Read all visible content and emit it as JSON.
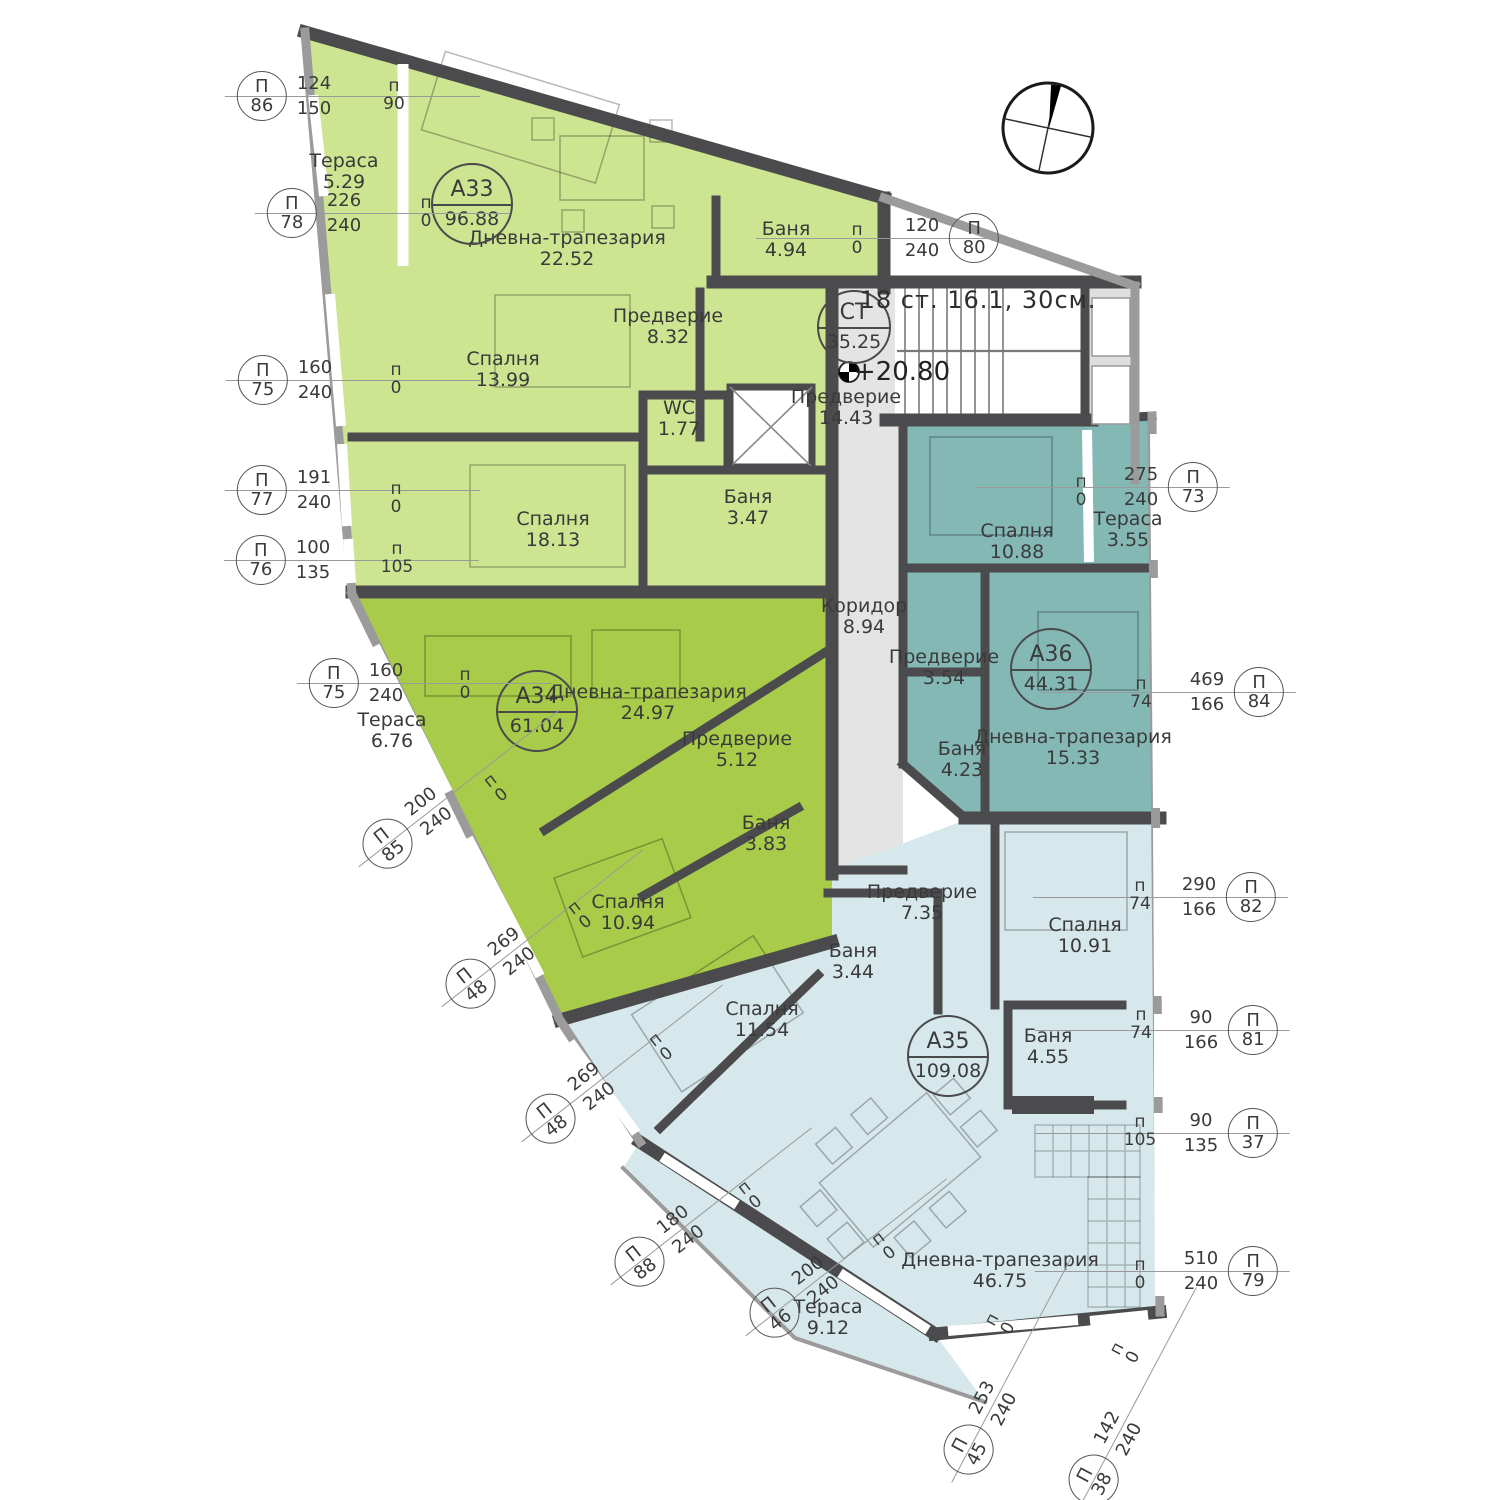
{
  "meta": {
    "tag_letter": "П",
    "sill_letter": "п",
    "plan_type": "apartment-floor-plan"
  },
  "colors": {
    "apartment_a33": "#cde491",
    "apartment_a34": "#a8cc49",
    "apartment_a35": "#d7e8ec",
    "apartment_a36": "#83b8b5",
    "common_area": "#e4e4e4",
    "walls": "#4b4b4d",
    "facade": "#9b9b9b",
    "text": "#3a3a3a"
  },
  "badges": [
    {
      "id": "СТ",
      "area": "35.25",
      "x": 854,
      "y": 327,
      "small": true
    },
    {
      "id": "А33",
      "area": "96.88",
      "x": 472,
      "y": 204
    },
    {
      "id": "А34",
      "area": "61.04",
      "x": 537,
      "y": 711
    },
    {
      "id": "А35",
      "area": "109.08",
      "x": 948,
      "y": 1056
    },
    {
      "id": "А36",
      "area": "44.31",
      "x": 1051,
      "y": 669
    }
  ],
  "rooms": [
    {
      "name": "Тераса",
      "area": "5.29",
      "x": 344,
      "y": 172
    },
    {
      "name": "Дневна-трапезария",
      "area": "22.52",
      "x": 567,
      "y": 249
    },
    {
      "name": "Предверие",
      "area": "8.32",
      "x": 668,
      "y": 327
    },
    {
      "name": "Спалня",
      "area": "13.99",
      "x": 503,
      "y": 370
    },
    {
      "name": "WC",
      "area": "1.77",
      "x": 679,
      "y": 419
    },
    {
      "name": "Баня",
      "area": "4.94",
      "x": 786,
      "y": 240
    },
    {
      "name": "Баня",
      "area": "3.47",
      "x": 748,
      "y": 508
    },
    {
      "name": "Спалня",
      "area": "18.13",
      "x": 553,
      "y": 530
    },
    {
      "name": "Предверие",
      "area": "14.43",
      "x": 846,
      "y": 408
    },
    {
      "name": "Коридор",
      "area": "8.94",
      "x": 864,
      "y": 617
    },
    {
      "name": "Тераса",
      "area": "6.76",
      "x": 392,
      "y": 731
    },
    {
      "name": "Дневна-трапезария",
      "area": "24.97",
      "x": 648,
      "y": 703
    },
    {
      "name": "Предверие",
      "area": "5.12",
      "x": 737,
      "y": 750
    },
    {
      "name": "Баня",
      "area": "3.83",
      "x": 766,
      "y": 834
    },
    {
      "name": "Спалня",
      "area": "10.94",
      "x": 628,
      "y": 913
    },
    {
      "name": "Спалня",
      "area": "10.88",
      "x": 1017,
      "y": 542
    },
    {
      "name": "Тераса",
      "area": "3.55",
      "x": 1128,
      "y": 530
    },
    {
      "name": "Предверие",
      "area": "3.54",
      "x": 944,
      "y": 668
    },
    {
      "name": "Баня",
      "area": "4.23",
      "x": 962,
      "y": 760
    },
    {
      "name": "Дневна-трапезария",
      "area": "15.33",
      "x": 1073,
      "y": 748
    },
    {
      "name": "Предверие",
      "area": "7.35",
      "x": 922,
      "y": 903
    },
    {
      "name": "Спалня",
      "area": "10.91",
      "x": 1085,
      "y": 936
    },
    {
      "name": "Баня",
      "area": "3.44",
      "x": 853,
      "y": 962
    },
    {
      "name": "Баня",
      "area": "4.55",
      "x": 1048,
      "y": 1047
    },
    {
      "name": "Спалня",
      "area": "11.54",
      "x": 762,
      "y": 1020
    },
    {
      "name": "Дневна-трапезария",
      "area": "46.75",
      "x": 1000,
      "y": 1271
    },
    {
      "name": "Тераса",
      "area": "9.12",
      "x": 828,
      "y": 1318
    }
  ],
  "window_tags": [
    {
      "num": "86",
      "d1": "124",
      "d2": "150",
      "x": 284,
      "y": 96,
      "side": "L",
      "rot": 0
    },
    {
      "num": "78",
      "d1": "226",
      "d2": "240",
      "x": 314,
      "y": 213,
      "side": "L",
      "rot": 0
    },
    {
      "num": "75",
      "d1": "160",
      "d2": "240",
      "x": 285,
      "y": 380,
      "side": "L",
      "rot": 0
    },
    {
      "num": "77",
      "d1": "191",
      "d2": "240",
      "x": 284,
      "y": 490,
      "side": "L",
      "rot": 0
    },
    {
      "num": "76",
      "d1": "100",
      "d2": "135",
      "x": 283,
      "y": 560,
      "side": "L",
      "rot": 0
    },
    {
      "num": "75",
      "d1": "160",
      "d2": "240",
      "x": 356,
      "y": 683,
      "side": "L",
      "rot": 0
    },
    {
      "num": "85",
      "d1": "200",
      "d2": "240",
      "x": 405,
      "y": 830,
      "side": "L",
      "rot": -38
    },
    {
      "num": "48",
      "d1": "269",
      "d2": "240",
      "x": 488,
      "y": 970,
      "side": "L",
      "rot": -38
    },
    {
      "num": "48",
      "d1": "269",
      "d2": "240",
      "x": 568,
      "y": 1105,
      "side": "L",
      "rot": -38
    },
    {
      "num": "88",
      "d1": "180",
      "d2": "240",
      "x": 657,
      "y": 1248,
      "side": "L",
      "rot": -38
    },
    {
      "num": "46",
      "d1": "200",
      "d2": "240",
      "x": 792,
      "y": 1299,
      "side": "L",
      "rot": -38
    },
    {
      "num": "45",
      "d1": "253",
      "d2": "240",
      "x": 979,
      "y": 1430,
      "side": "L",
      "rot": -62
    },
    {
      "num": "38",
      "d1": "142",
      "d2": "240",
      "x": 1104,
      "y": 1460,
      "side": "L",
      "rot": -62
    },
    {
      "num": "80",
      "d1": "120",
      "d2": "240",
      "x": 952,
      "y": 238,
      "side": "R",
      "rot": 0
    },
    {
      "num": "73",
      "d1": "275",
      "d2": "240",
      "x": 1171,
      "y": 487,
      "side": "R",
      "rot": 0
    },
    {
      "num": "84",
      "d1": "469",
      "d2": "166",
      "x": 1237,
      "y": 692,
      "side": "R",
      "rot": 0
    },
    {
      "num": "82",
      "d1": "290",
      "d2": "166",
      "x": 1229,
      "y": 897,
      "side": "R",
      "rot": 0
    },
    {
      "num": "81",
      "d1": "90",
      "d2": "166",
      "x": 1231,
      "y": 1030,
      "side": "R",
      "rot": 0
    },
    {
      "num": "37",
      "d1": "90",
      "d2": "135",
      "x": 1231,
      "y": 1133,
      "side": "R",
      "rot": 0
    },
    {
      "num": "79",
      "d1": "510",
      "d2": "240",
      "x": 1231,
      "y": 1271,
      "side": "R",
      "rot": 0
    }
  ],
  "sill_marks": [
    {
      "val": "90",
      "x": 394,
      "y": 95,
      "rot": 0
    },
    {
      "val": "0",
      "x": 426,
      "y": 212,
      "rot": 0
    },
    {
      "val": "0",
      "x": 857,
      "y": 239,
      "rot": 0
    },
    {
      "val": "0",
      "x": 396,
      "y": 379,
      "rot": 0
    },
    {
      "val": "0",
      "x": 396,
      "y": 498,
      "rot": 0
    },
    {
      "val": "105",
      "x": 397,
      "y": 558,
      "rot": 0
    },
    {
      "val": "0",
      "x": 465,
      "y": 684,
      "rot": 0
    },
    {
      "val": "0",
      "x": 496,
      "y": 788,
      "rot": -38
    },
    {
      "val": "0",
      "x": 580,
      "y": 915,
      "rot": -38
    },
    {
      "val": "0",
      "x": 661,
      "y": 1047,
      "rot": -38
    },
    {
      "val": "0",
      "x": 750,
      "y": 1195,
      "rot": -38
    },
    {
      "val": "0",
      "x": 884,
      "y": 1246,
      "rot": -38
    },
    {
      "val": "0",
      "x": 1000,
      "y": 1324,
      "rot": -62
    },
    {
      "val": "0",
      "x": 1125,
      "y": 1353,
      "rot": -62
    },
    {
      "val": "0",
      "x": 1081,
      "y": 491,
      "rot": 0
    },
    {
      "val": "74",
      "x": 1141,
      "y": 693,
      "rot": 0
    },
    {
      "val": "74",
      "x": 1140,
      "y": 895,
      "rot": 0
    },
    {
      "val": "74",
      "x": 1141,
      "y": 1024,
      "rot": 0
    },
    {
      "val": "105",
      "x": 1140,
      "y": 1131,
      "rot": 0
    },
    {
      "val": "0",
      "x": 1140,
      "y": 1274,
      "rot": 0
    }
  ],
  "notes": {
    "stairs": "18 ст. 16.1, 30см.",
    "elevation": "+20.80"
  }
}
